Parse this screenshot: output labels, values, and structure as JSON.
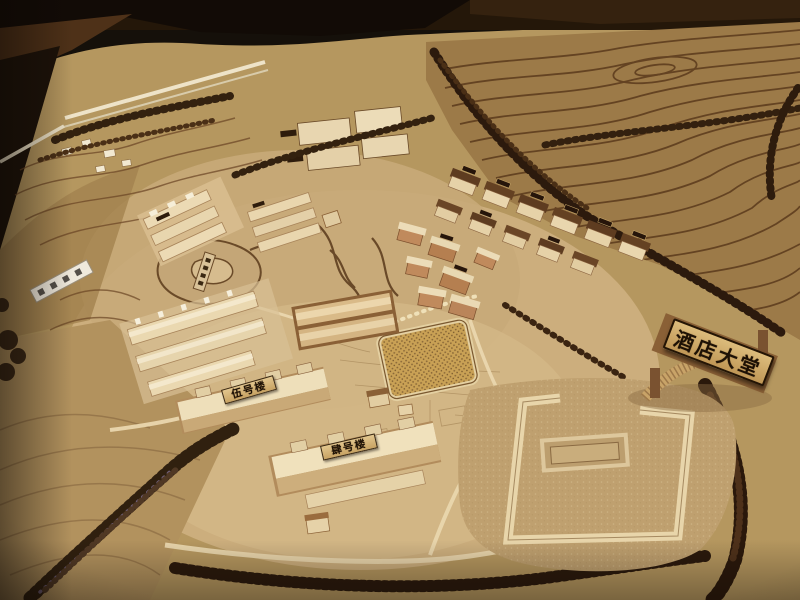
{
  "photo": {
    "subject_signs": {
      "hotel_lobby": "酒店大堂",
      "building_no5": "伍号楼",
      "building_no4": "肆号楼"
    },
    "palette": {
      "background_dark": "#15100a",
      "board_tan": "#c2a473",
      "flat_light_tan": "#d4b888",
      "terrace_brown": "#9c7a48",
      "contour_line": "#5a381c",
      "building_wood": "#ecdab4",
      "roof_dark": "#5e3c20",
      "village_wall": "#c08a5c",
      "tree_dark": "#2e1c0d",
      "tree_purple_fleck": "#6f5e78",
      "sign_board_gold": "#d3ab66",
      "sign_text": "#1d1105",
      "white_sign": "#efe9dc",
      "road_cream": "#ead7ae",
      "table_wood": "#4e3118"
    }
  }
}
